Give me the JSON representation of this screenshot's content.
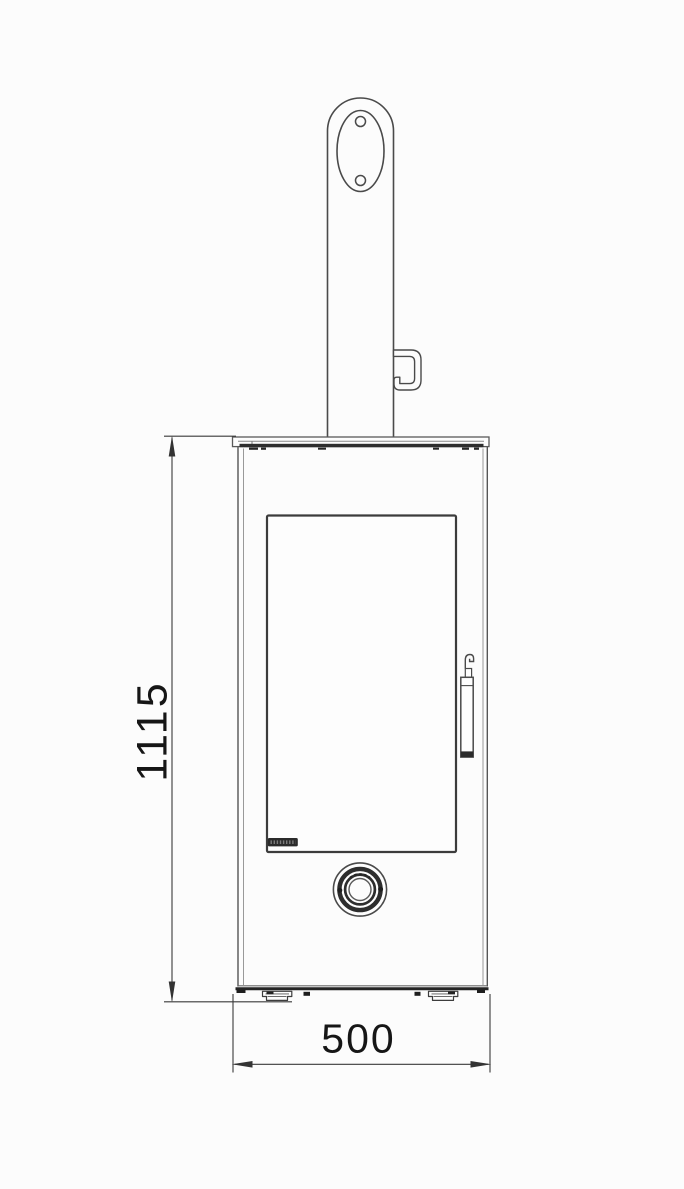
{
  "page": {
    "background": "#fcfcfc",
    "description": "Black-and-white technical line drawing: front elevation of a freestanding wood stove with flue pipe, glass door, handle, control knob and dimension lines"
  },
  "drawing": {
    "colors": {
      "line": "#4a4a4a",
      "line_light": "#8a8a8a",
      "dark_fill": "#2b2b2b",
      "dimension_line": "#3a3a3a",
      "text": "#161616"
    },
    "components": [
      "flue-pipe",
      "flue-collar-flange",
      "screw-hole-top",
      "screw-hole-bottom",
      "damper-bracket",
      "top-plate",
      "stove-body",
      "door-window",
      "brand-logo",
      "door-handle",
      "control-knob",
      "adjustable-feet"
    ]
  },
  "dimensions": {
    "height": {
      "value": "1115",
      "orientation": "vertical",
      "side": "left"
    },
    "width": {
      "value": "500",
      "orientation": "horizontal",
      "side": "bottom"
    }
  }
}
